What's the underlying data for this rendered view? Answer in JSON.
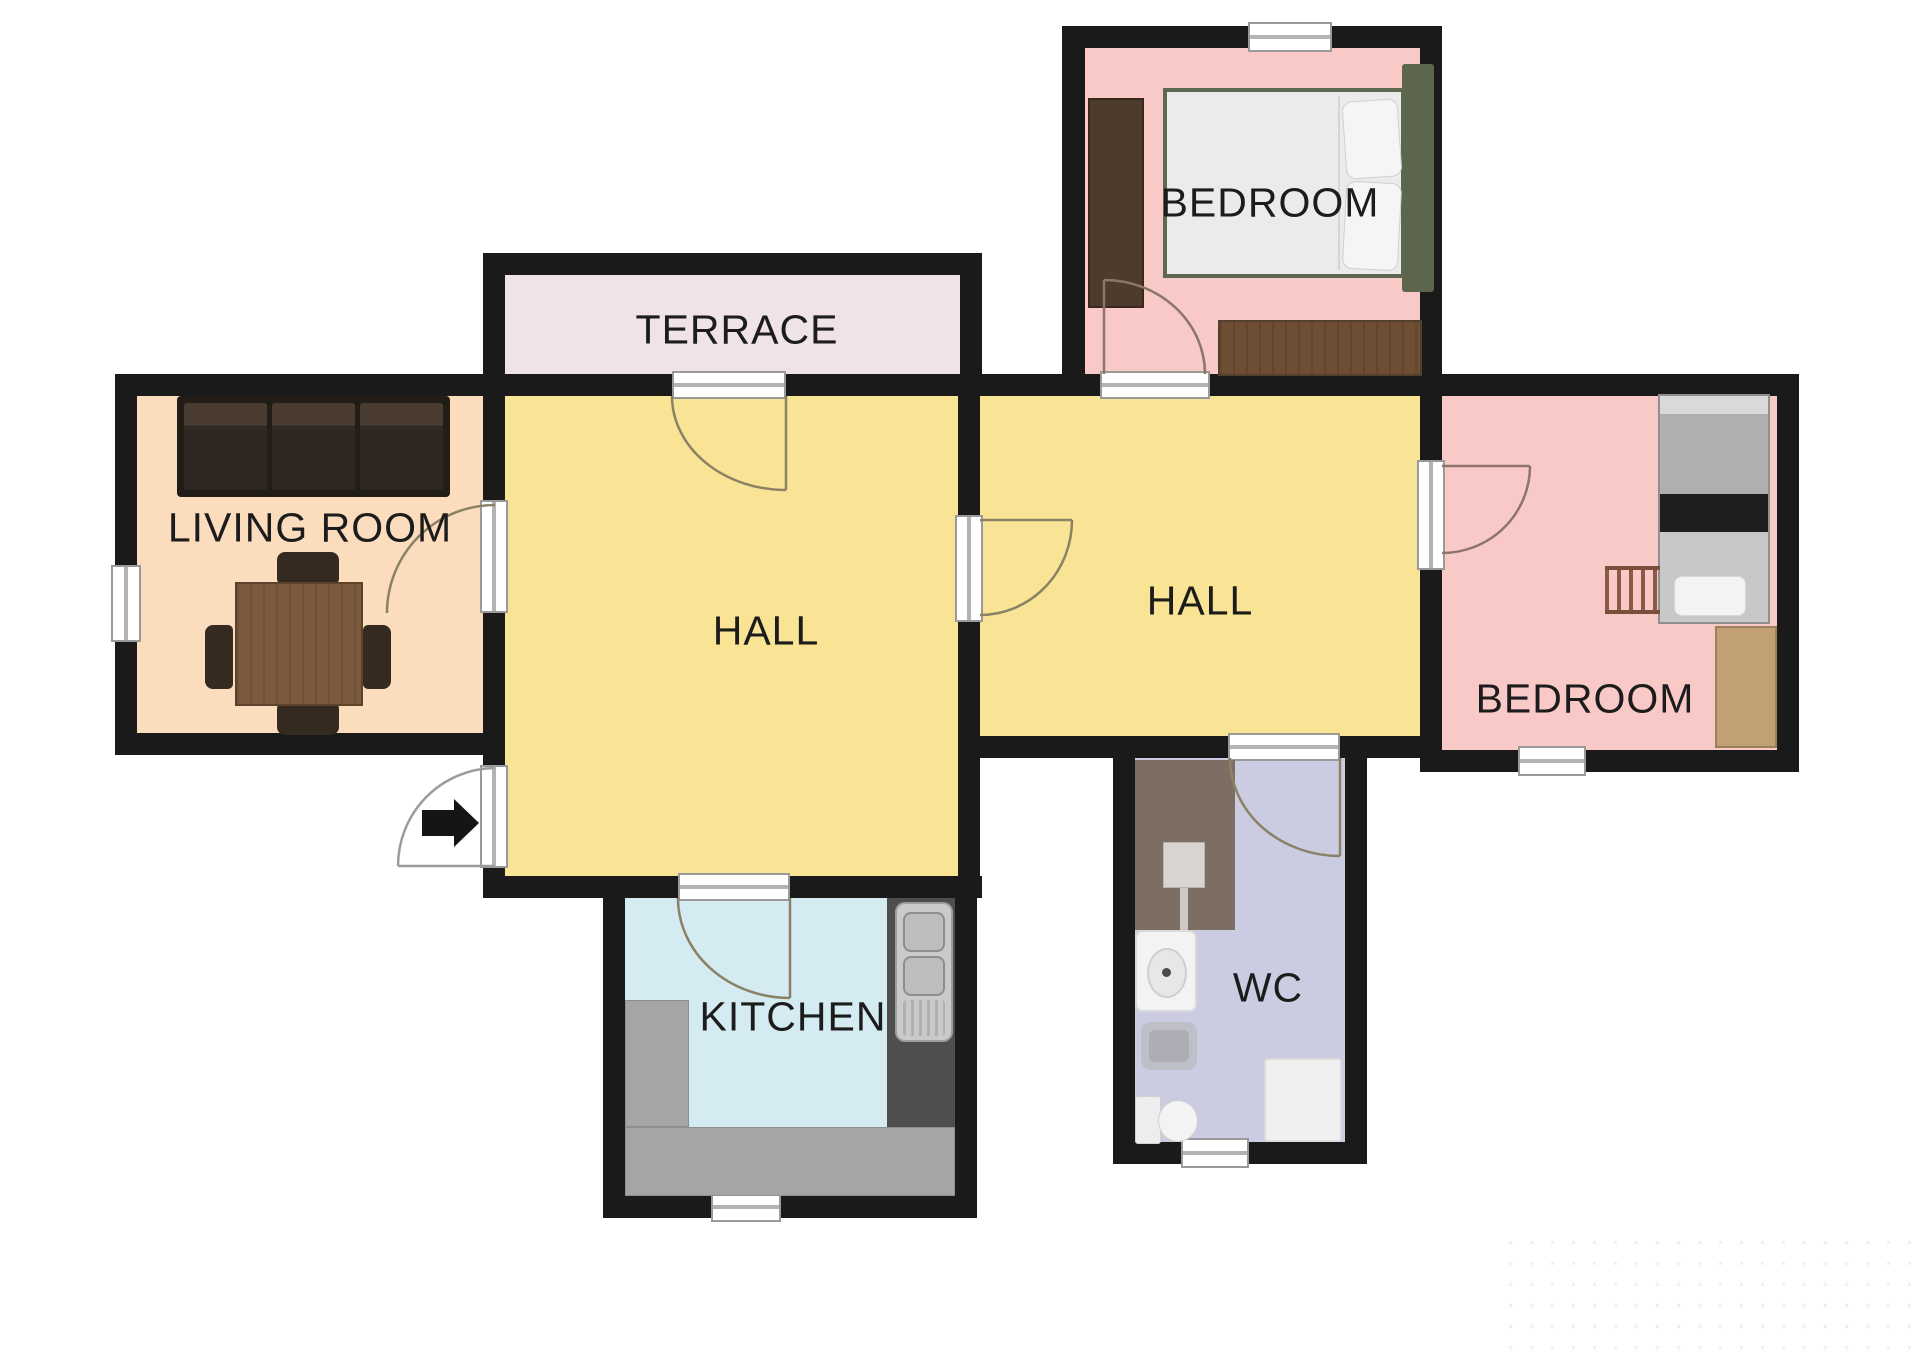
{
  "plan": {
    "rooms": {
      "terrace": {
        "label": "TERRACE"
      },
      "living_room": {
        "label": "LIVING ROOM"
      },
      "hall_left": {
        "label": "HALL"
      },
      "hall_right": {
        "label": "HALL"
      },
      "bedroom_top": {
        "label": "BEDROOM"
      },
      "bedroom_right": {
        "label": "BEDROOM"
      },
      "kitchen": {
        "label": "KITCHEN"
      },
      "wc": {
        "label": "WC"
      }
    },
    "colors": {
      "wall": "#1A1A1A",
      "hall_fill": "#F8E494",
      "living_room_fill": "#FBDDBE",
      "bedroom_fill": "#F9C9C8",
      "terrace_fill": "#EFE3E5",
      "kitchen_fill": "#D5EBF2",
      "wc_fill": "#CBCCE2",
      "door_swing": "#8B8266",
      "label_text": "#1C1C1C"
    }
  }
}
